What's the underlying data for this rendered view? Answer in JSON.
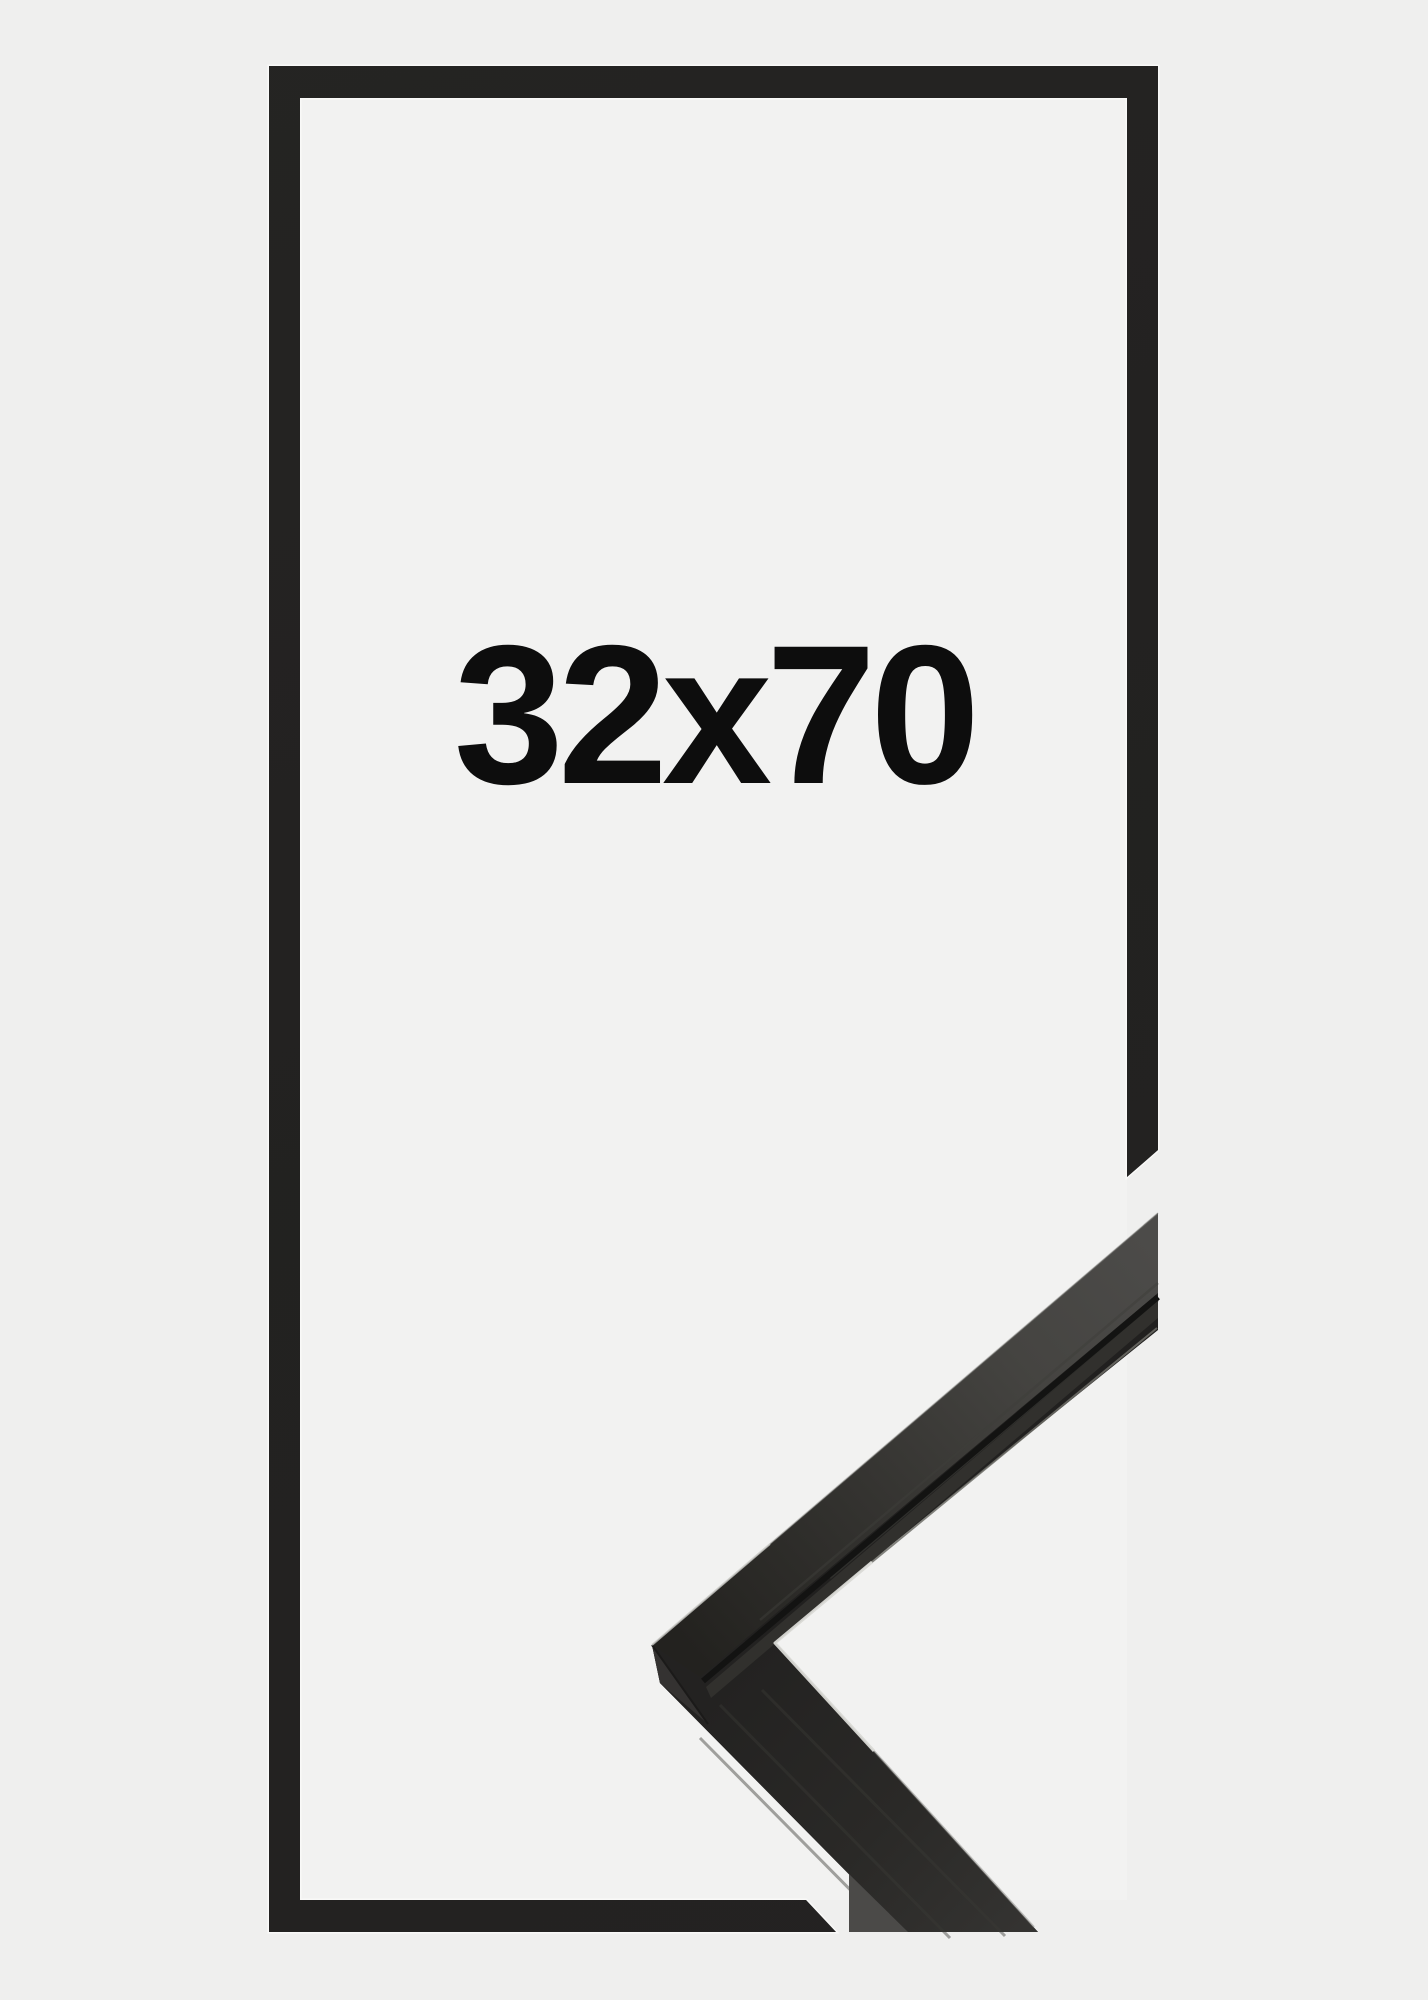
{
  "product": {
    "size_label": "32x70"
  },
  "colors": {
    "background": "#efefee",
    "frame_interior": "#f2f2f1",
    "frame_front": "#232221",
    "frame_halo": "#f9f9f8",
    "label_text": "#0d0d0d",
    "sample_base": "#21201f",
    "sample_top_face_light": "#4c4b49",
    "sample_lip": "#31302d",
    "sample_groove": "#131312",
    "sample_miter_face": "#343231",
    "sample_end_face": "#4b4a48",
    "sample_highlight": "#d9d9d5",
    "sample_edge_highlight": "#8a8a86"
  }
}
